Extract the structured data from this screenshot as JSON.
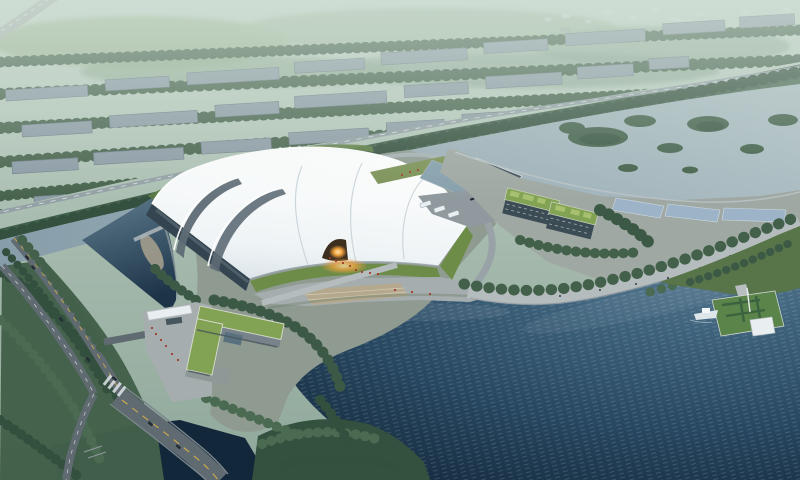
{
  "scene": {
    "type": "aerial-architectural-rendering",
    "setting": "lakeside cultural venue at dusk under green haze",
    "landmarks": {
      "main_hall": "white curved-shell exhibition hall",
      "entrance_glow": "illuminated arched entrance",
      "gate_building": "L-shaped green-roof gate building with white canopy",
      "office_blocks": "green-roof office buildings",
      "glass_canopies": "glass shelter canopies on waterfront spit",
      "promenade": "curved lakeside promenade with tree rows",
      "pier": "floating garden pier with pavilion and boat",
      "lake": "large dark lake",
      "river": "river with wooded islands",
      "pond": "entry pond beside the hall",
      "avenue": "tree-lined dual avenue with bridge over inlet",
      "city": "low-rise city blocks fading into haze"
    }
  },
  "colors": {
    "haze_top": "#c3d3c7",
    "haze_deep": "#8fa89b",
    "city_block": "#8d9ca6",
    "city_edge": "#6e7e88",
    "tree": "#42604a",
    "tree_dark": "#34503e",
    "tree_light": "#4a6a52",
    "tree_belt": "#3f5d48",
    "river_near": "#879eaa",
    "river_far": "#abbcc2",
    "lake_light": "#61839a",
    "lake_deep": "#0f2234",
    "pond_top": "#5f7c8e",
    "pond_deep": "#1d3448",
    "inlet": "#13273b",
    "land_base": "#8f9b91",
    "spit_base": "#9fa8a2",
    "bank_green": "#587549",
    "roof_white": "#f7fafb",
    "roof_shade": "#d9e2e8",
    "roof_groove": "#5e6c75",
    "facade_dark": "#344450",
    "lawn": "#6d8c48",
    "lawn_dark": "#5d7d44",
    "plaza": "#a6adaf",
    "promenade": "#b5bcbe",
    "steps_tan": "#b4a98f",
    "road": "#5f6a71",
    "lane_yellow": "#c9a84e",
    "lane_white": "#e4e9ea",
    "parking": "#8f999e",
    "green_roof": "#82a254",
    "green_roof_patch": "#a6c06f",
    "dark_building": "#3c4c55",
    "canopy_white": "#e9eef0",
    "canopy_glass": "#9db4c8",
    "glow_core": "#ffe7b0",
    "glow_warm": "#f2a23d",
    "pier_grass": "#5a8449",
    "boat_white": "#dde6e9",
    "people_red": "#a03c2c",
    "car_dark": "#232d35",
    "gravel": "#a39d8d",
    "marina": "#87a0ad"
  }
}
